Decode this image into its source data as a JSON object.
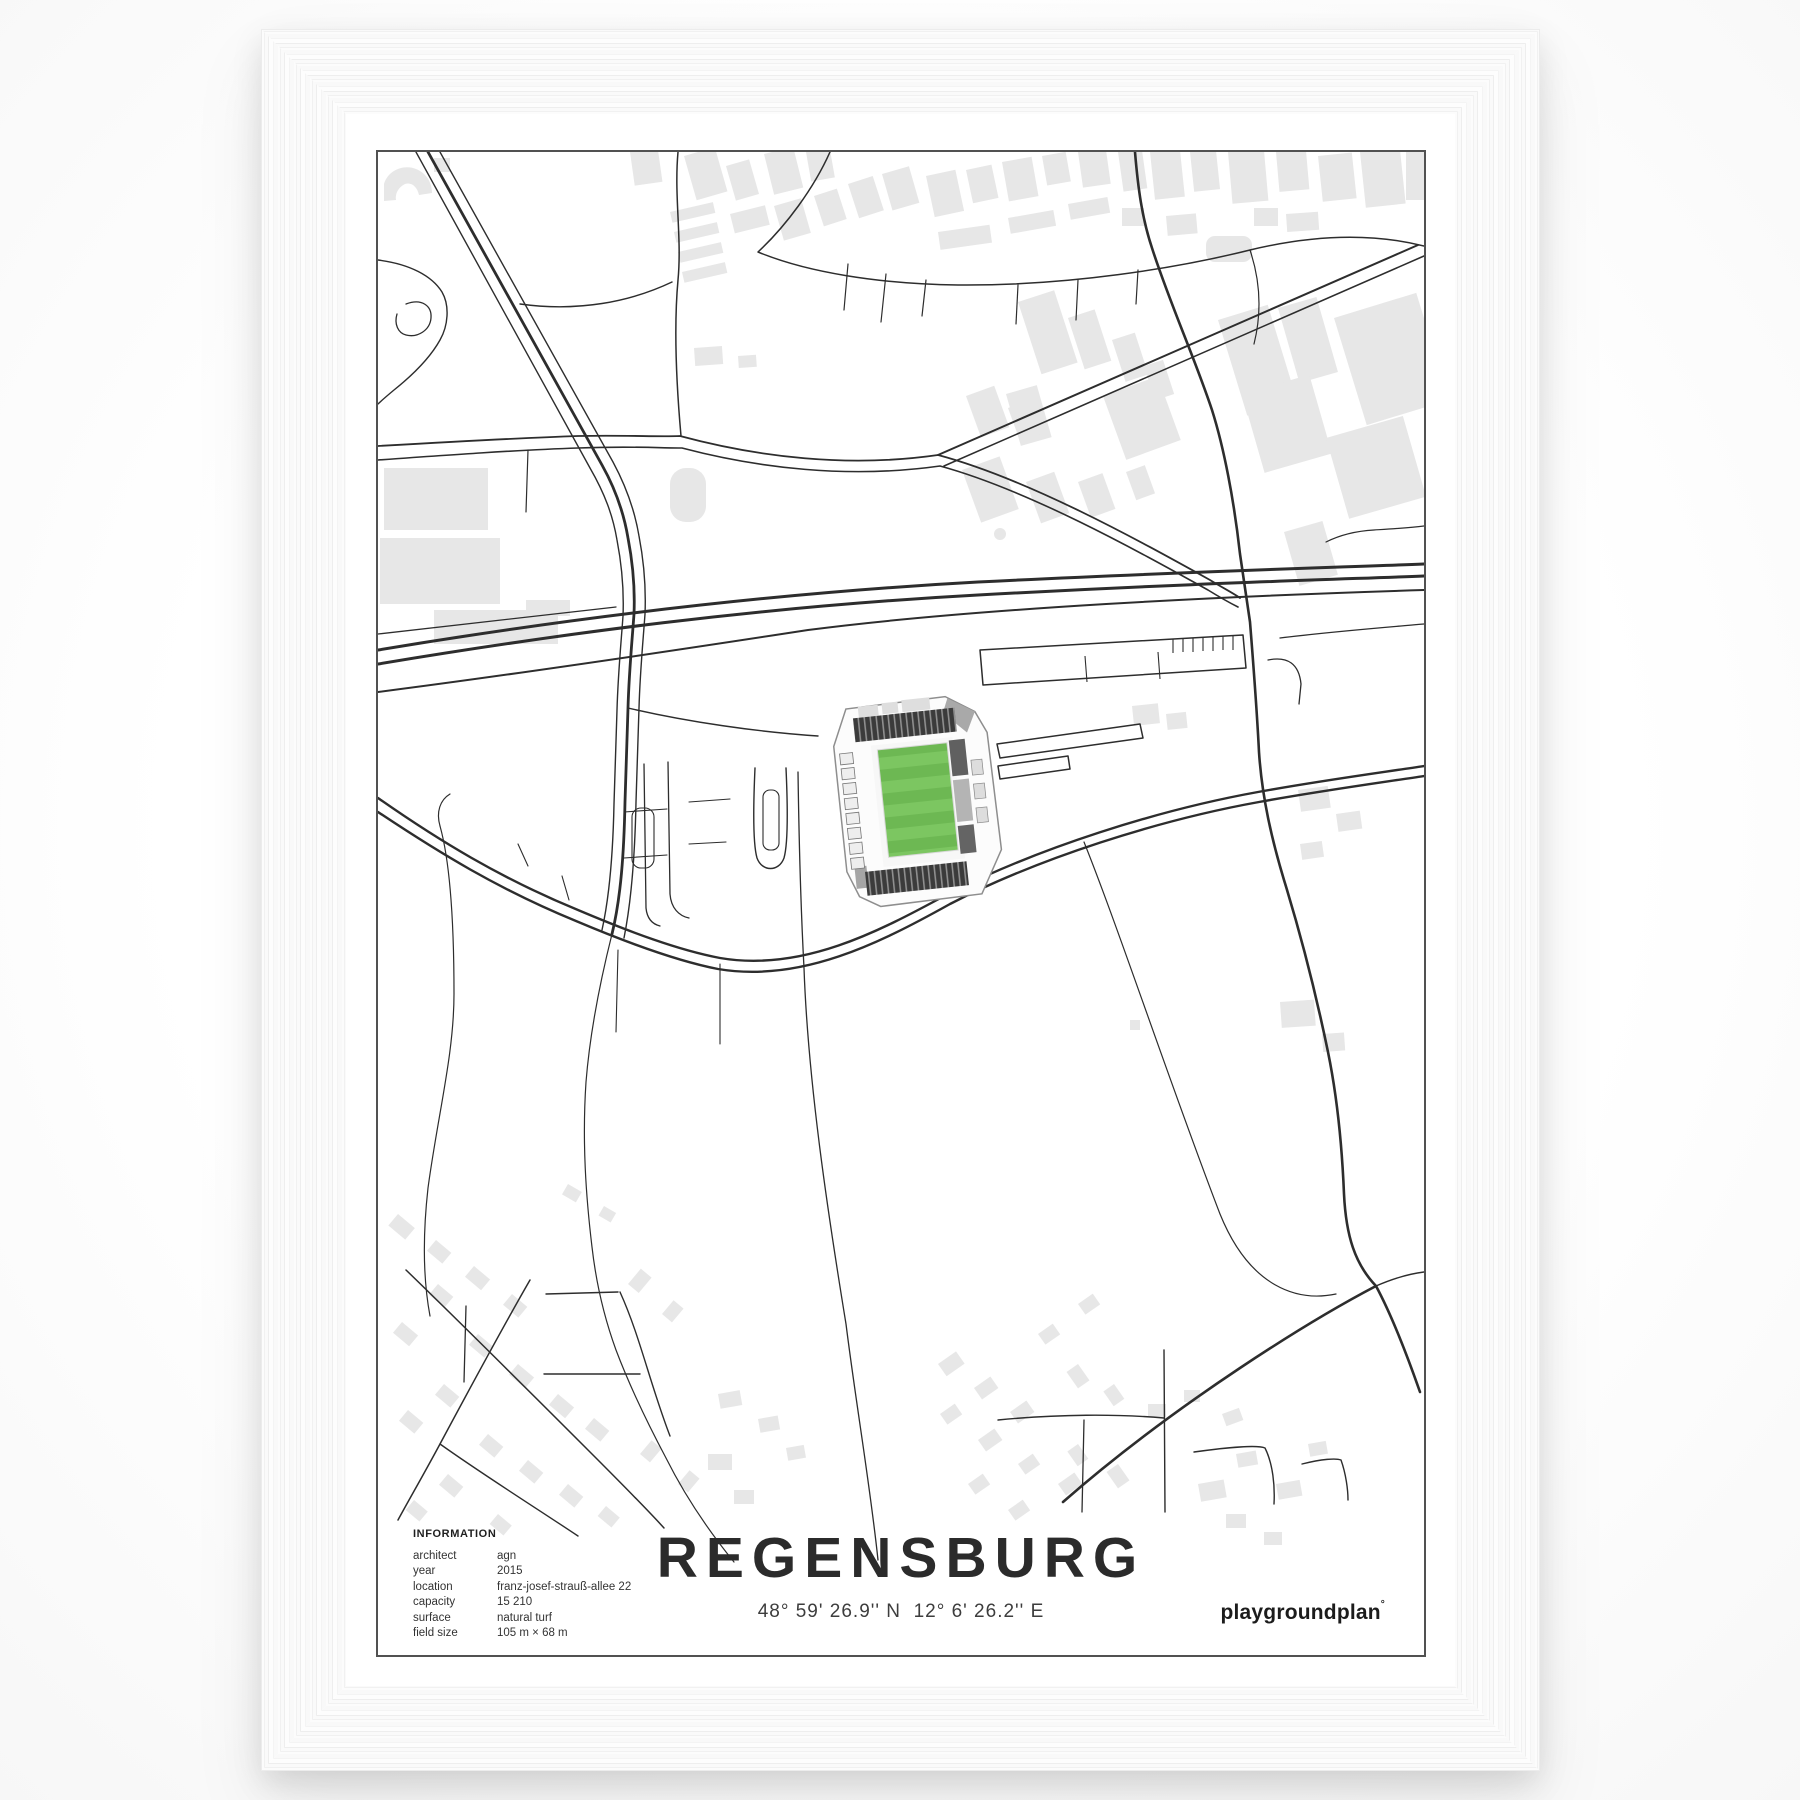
{
  "poster": {
    "title": "REGENSBURG",
    "coordinates": "48° 59' 26.9'' N  12° 6' 26.2'' E",
    "brand": "playgroundplan",
    "brand_mark": "°",
    "info": {
      "heading": "INFORMATION",
      "rows": [
        {
          "label": "architect",
          "value": "agn"
        },
        {
          "label": "year",
          "value": "2015"
        },
        {
          "label": "location",
          "value": "franz-josef-strauß-allee 22"
        },
        {
          "label": "capacity",
          "value": "15 210"
        },
        {
          "label": "surface",
          "value": "natural turf"
        },
        {
          "label": "field size",
          "value": "105 m × 68 m"
        }
      ]
    },
    "colors": {
      "road": "#2d2d2d",
      "building_gray": "#e7e7e7",
      "pitch_light": "#7cc661",
      "pitch_dark": "#6db853",
      "stand_dark": "#3b3b3b",
      "border": "#515151"
    }
  }
}
